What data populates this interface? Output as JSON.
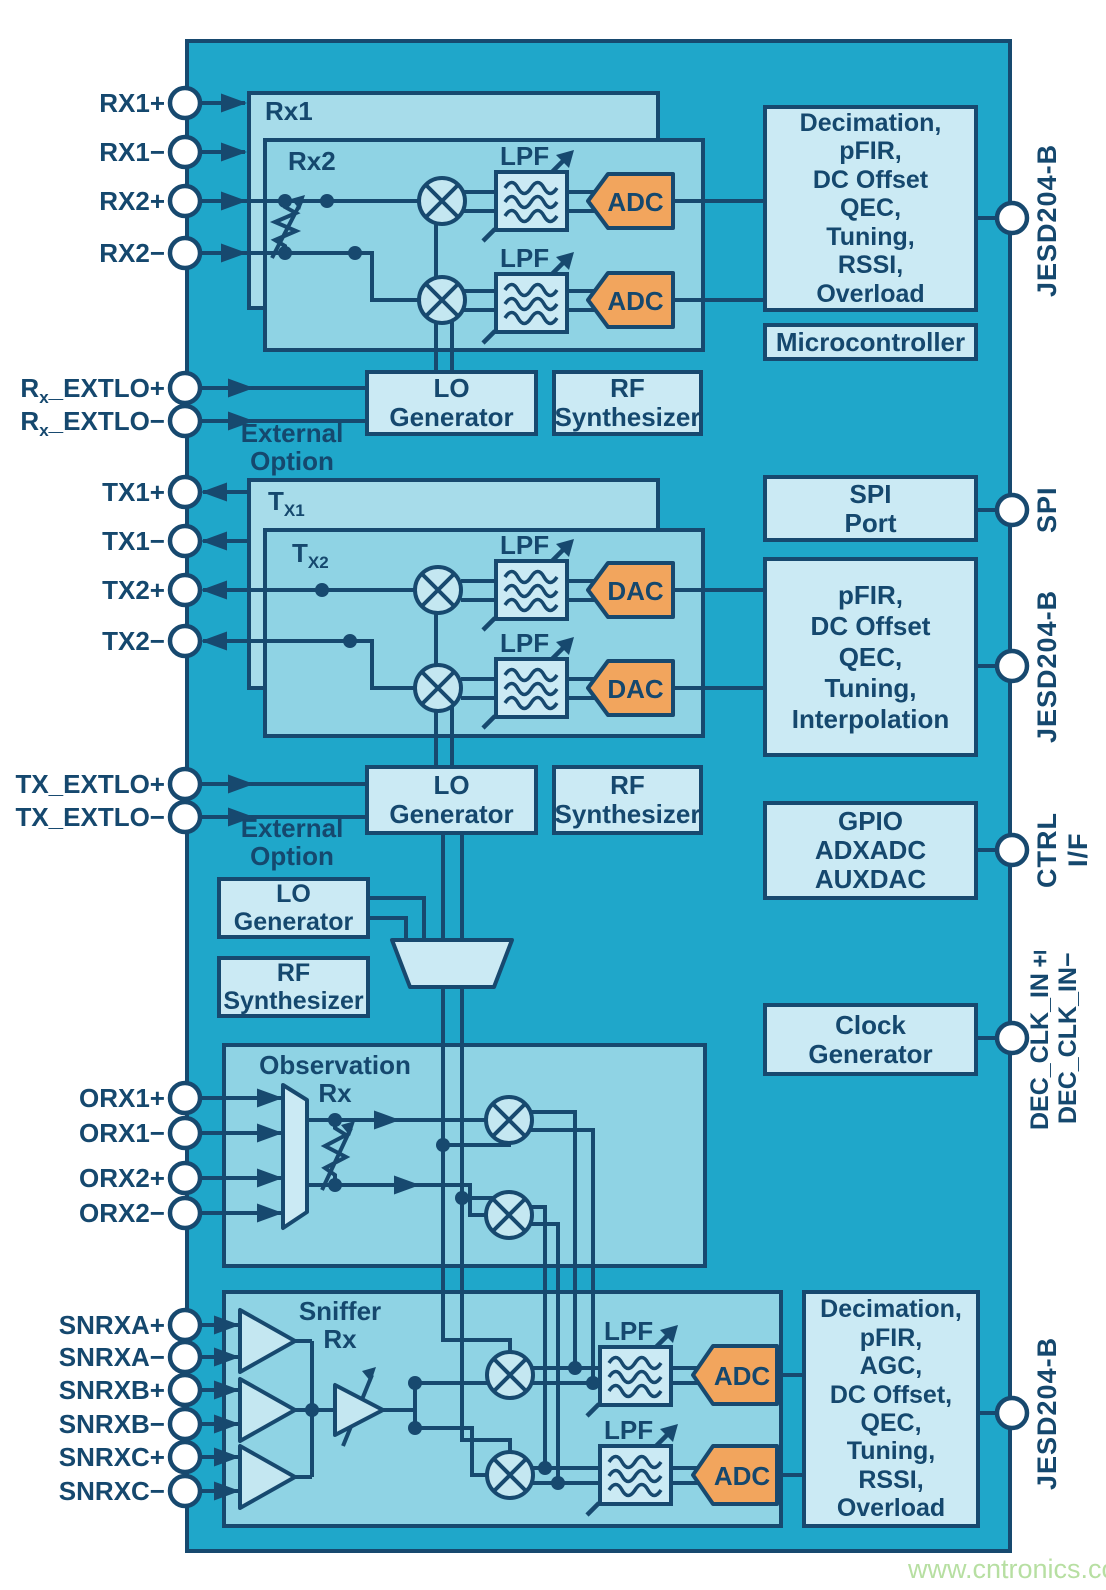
{
  "watermark": "www.cntronics.com",
  "colors": {
    "chip_teal": "#1FA7CA",
    "container_light": "#A7DCEA",
    "container_mid": "#8FD3E4",
    "panel_lightest": "#CBEAF4",
    "accent_orange": "#F2A55D",
    "line_navy": "#17496F",
    "watermark_green": "#B7DFA2"
  },
  "pins": {
    "left": [
      {
        "pre": "RX1+",
        "sub": "",
        "post": ""
      },
      {
        "pre": "RX1−",
        "sub": "",
        "post": ""
      },
      {
        "pre": "RX2+",
        "sub": "",
        "post": ""
      },
      {
        "pre": "RX2−",
        "sub": "",
        "post": ""
      },
      {
        "pre": "R",
        "sub": "x",
        "post": "_EXTLO+"
      },
      {
        "pre": "R",
        "sub": "x",
        "post": "_EXTLO−"
      },
      {
        "pre": "TX1+",
        "sub": "",
        "post": ""
      },
      {
        "pre": "TX1−",
        "sub": "",
        "post": ""
      },
      {
        "pre": "TX2+",
        "sub": "",
        "post": ""
      },
      {
        "pre": "TX2−",
        "sub": "",
        "post": ""
      },
      {
        "pre": "TX_EXTLO+",
        "sub": "",
        "post": ""
      },
      {
        "pre": "TX_EXTLO−",
        "sub": "",
        "post": ""
      },
      {
        "pre": "ORX1+",
        "sub": "",
        "post": ""
      },
      {
        "pre": "ORX1−",
        "sub": "",
        "post": ""
      },
      {
        "pre": "ORX2+",
        "sub": "",
        "post": ""
      },
      {
        "pre": "ORX2−",
        "sub": "",
        "post": ""
      },
      {
        "pre": "SNRXA+",
        "sub": "",
        "post": ""
      },
      {
        "pre": "SNRXA−",
        "sub": "",
        "post": ""
      },
      {
        "pre": "SNRXB+",
        "sub": "",
        "post": ""
      },
      {
        "pre": "SNRXB−",
        "sub": "",
        "post": ""
      },
      {
        "pre": "SNRXC+",
        "sub": "",
        "post": ""
      },
      {
        "pre": "SNRXC−",
        "sub": "",
        "post": ""
      }
    ],
    "right": [
      {
        "label": "JESD204-B"
      },
      {
        "label": "SPI"
      },
      {
        "label": "JESD204-B"
      },
      {
        "label": "CTRL I/F"
      },
      {
        "label": "DEC_CLK_IN±",
        "label2": "DEC_CLK_IN−"
      },
      {
        "label": "JESD204-B"
      }
    ]
  },
  "blocks": {
    "rx1": "Rx1",
    "rx2": "Rx2",
    "tx1": {
      "pre": "T",
      "sub": "X1"
    },
    "tx2": {
      "pre": "T",
      "sub": "X2"
    },
    "lpf": "LPF",
    "adc": "ADC",
    "dac": "DAC",
    "rx_dsp": {
      "lines": [
        "Decimation,",
        "pFIR,",
        "DC Offset",
        "QEC,",
        "Tuning,",
        "RSSI,",
        "Overload"
      ]
    },
    "microcontroller": "Microcontroller",
    "lo_generator": {
      "line1": "LO",
      "line2": "Generator"
    },
    "rf_synthesizer": {
      "line1": "RF",
      "line2": "Synthesizer"
    },
    "external_option": {
      "line1": "External",
      "line2": "Option"
    },
    "spi_port": {
      "line1": "SPI",
      "line2": "Port"
    },
    "tx_dsp": {
      "lines": [
        "pFIR,",
        "DC Offset",
        "QEC,",
        "Tuning,",
        "Interpolation"
      ]
    },
    "gpio": {
      "lines": [
        "GPIO",
        "ADXADC",
        "AUXDAC"
      ]
    },
    "clock_generator": {
      "line1": "Clock",
      "line2": "Generator"
    },
    "observation_rx": {
      "line1": "Observation",
      "line2": "Rx"
    },
    "sniffer_rx": {
      "line1": "Sniffer",
      "line2": "Rx"
    },
    "sniffer_dsp": {
      "lines": [
        "Decimation,",
        "pFIR,",
        "AGC,",
        "DC Offset,",
        "QEC,",
        "Tuning,",
        "RSSI,",
        "Overload"
      ]
    }
  }
}
